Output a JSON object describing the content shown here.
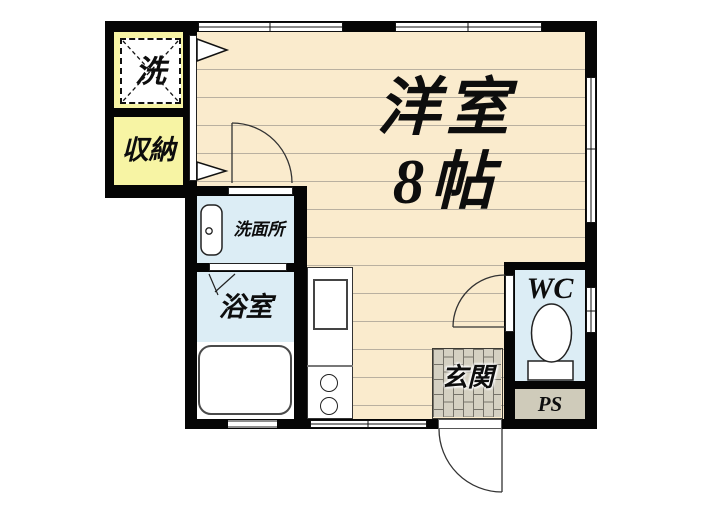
{
  "plan": {
    "type": "apartment-floor-plan",
    "rooms": {
      "main_room": {
        "name_line1": "洋室",
        "name_line2": "8帖"
      },
      "washer_space": {
        "label": "洗"
      },
      "storage": {
        "label": "収納"
      },
      "washroom": {
        "label": "洗面所"
      },
      "bathroom": {
        "label": "浴室"
      },
      "wc": {
        "label": "WC"
      },
      "pipe_space": {
        "label": "PS"
      },
      "entrance": {
        "label": "玄関"
      }
    },
    "colors": {
      "wall": "#050505",
      "flooring": "#FAEBCD",
      "flooring_line": "#B9B0A0",
      "closet_yellow": "#F7F4A4",
      "wet_area_blue": "#DCEDF5",
      "pipe_space_tan": "#CFCBBA",
      "entrance_tile": "#D4D0C2"
    }
  }
}
